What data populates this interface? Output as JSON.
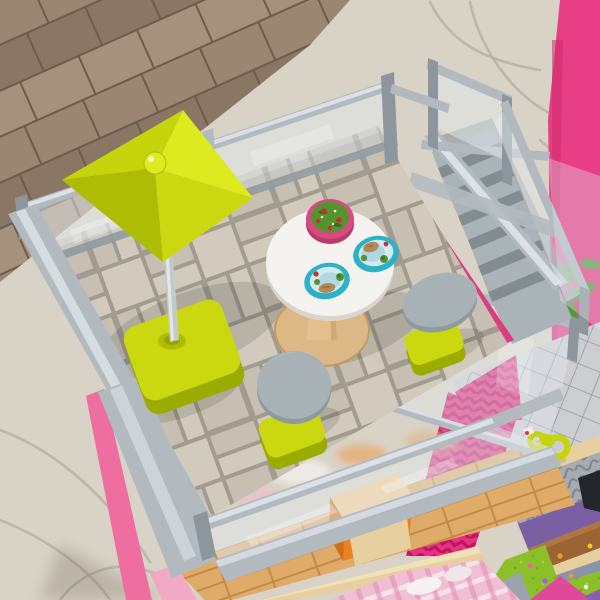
{
  "image": {
    "kind": "product photograph",
    "subject": "Overhead view of a toy dollhouse rooftop terrace with glass-panel railings",
    "setting": "Dollhouse standing on a wood plank floor with a beige area rug"
  },
  "scene": {
    "background": {
      "wood_floor": "diagonal brown wood planks, upper left",
      "area_rug": "beige rug with thin gray veins, right side and lower left"
    },
    "terrace": {
      "floor": "beige stone-paver tiles with gray grout",
      "railing": "clear acrylic panels with gray frames on all sides",
      "umbrella": {
        "canopy": "square chartreuse market umbrella with ball finial",
        "pole": "gray pole",
        "base": "chartreuse square base"
      },
      "table": {
        "top": "round white bistro table",
        "base": "natural wood pedestal disc"
      },
      "dishes": [
        {
          "name": "salad bowl",
          "rim": "pink",
          "contents": "green salad with red tomatoes"
        },
        {
          "name": "dinner plate right",
          "rim": "teal",
          "contents": "roast, broccoli, tomato"
        },
        {
          "name": "dinner plate left",
          "rim": "teal",
          "contents": "fish, broccoli, tomato"
        }
      ],
      "stools": [
        {
          "name": "stool front",
          "seat": "gray round seat",
          "base": "chartreuse base"
        },
        {
          "name": "stool right",
          "seat": "gray round seat",
          "base": "chartreuse base"
        }
      ]
    },
    "staircase": {
      "steps": "gray molded steps descending to lower balcony",
      "railings": "clear panels with gray caps and posts",
      "stringer": "pink beam with dark slots along terrace edge"
    },
    "lower_floors": {
      "balcony": "gray diamond-tile balcony with chartreuse toy shower sprayer",
      "middle_floor": "light wood plank floor with orange toy furniture",
      "walls": [
        "pink chevron-textured wall",
        "purple wall",
        "bright pink exterior wall with plant"
      ],
      "bedroom": "pink plaid bedding with white pillows",
      "yard": "green grass mat with tiny flowers",
      "extras": [
        "silver textured rug",
        "brown wood beams",
        "brick floor strip"
      ]
    }
  },
  "palette": {
    "rug": "#d9d2c6",
    "rug_vein": "#b4ac9f",
    "wood_a": "#9a8673",
    "wood_b": "#8a7664",
    "wood_c": "#a5917e",
    "wood_seam": "#6d5b4b",
    "pink_wall": "#e73e85",
    "pink_wall_dark": "#cf2a6e",
    "pink_edge": "#ee6f9f",
    "pink_beam": "#dc3c80",
    "pink_slot": "#a81f58",
    "pink_zigzag": "#e23480",
    "pink_zigzag_dark": "#c2135f",
    "gray_frame": "#b2bac0",
    "gray_frame_dark": "#8d969c",
    "gray_frame_light": "#e2e8ec",
    "glass": "rgba(226,233,238,0.5)",
    "glass_streak": "rgba(255,255,255,0.6)",
    "tile": "#d1cabd",
    "tile_alt": "#c6bfb2",
    "grout": "#a19b90",
    "lime": "#cbd70f",
    "lime_light": "#dcea1f",
    "lime_mid": "#c6d40c",
    "lime_dark": "#aebd04",
    "lime_deep": "#9cab00",
    "pole_gray": "#c3cbc9",
    "table_white": "#f5f3ef",
    "table_edge": "#d9d5ce",
    "wood_base": "#ddb887",
    "wood_base_dark": "#c49a63",
    "plate_teal": "#2cb2c6",
    "plate_inner": "#d3e9ee",
    "plate_blue": "#b0d8e3",
    "bowl_pink": "#d84a84",
    "salad": "#57922f",
    "salad_dark": "#3c6e1f",
    "food_red": "#c63030",
    "food_tan": "#b38a55",
    "stool_gray": "#a8b2b6",
    "stool_dark": "#8f999e",
    "step_gray": "#aab3b8",
    "step_dark": "#828c91",
    "lower_wood": "#e0ab69",
    "lower_wood_seam": "#c08b47",
    "shelf_tan": "#e8cf9f",
    "orange_box": "#e9831f",
    "orange_box_top": "#f6c98f",
    "purple_wall": "#7b5fa3",
    "brown_beam": "#9c6434",
    "grass": "#8cc02a",
    "plaid_pink": "#f0bfd4",
    "plaid_line": "#e291b4",
    "silver_rug": "#a7abb2",
    "silver_rug_dark": "#7f848c",
    "diamond_tile": "#cdced2",
    "diamond_line": "#97989e",
    "blue_strip": "#8a93a8",
    "dark_corner": "#23262b",
    "plant_green": "#58963c",
    "brick_floor": "#c09a76",
    "brick_line": "#9f7a55"
  }
}
